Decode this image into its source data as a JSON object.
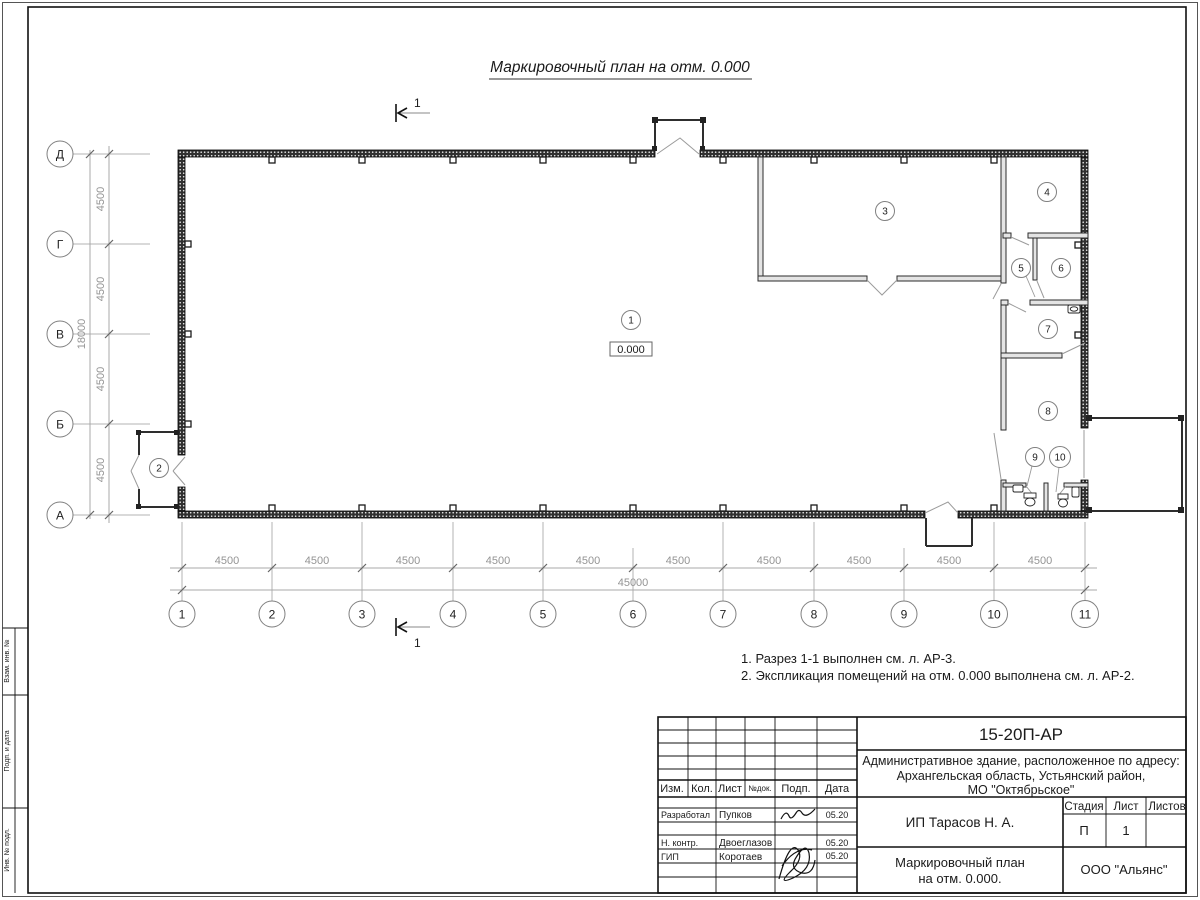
{
  "sheet": {
    "title": "Маркировочный план на отм. 0.000",
    "section_label": "1",
    "notes": [
      "1. Разрез 1-1 выполнен см. л. АР-3.",
      "2. Экспликация помещений на отм. 0.000 выполнена см. л. АР-2."
    ]
  },
  "plan": {
    "elevation": "0.000",
    "rooms": [
      "1",
      "2",
      "3",
      "4",
      "5",
      "6",
      "7",
      "8",
      "9",
      "10"
    ],
    "axes_h": [
      "1",
      "2",
      "3",
      "4",
      "5",
      "6",
      "7",
      "8",
      "9",
      "10",
      "11"
    ],
    "axes_v": [
      "Д",
      "Г",
      "В",
      "Б",
      "А"
    ],
    "dims_bottom": [
      "4500",
      "4500",
      "4500",
      "4500",
      "4500",
      "4500",
      "4500",
      "4500",
      "4500",
      "4500"
    ],
    "dim_bottom_total": "45000",
    "dims_left": [
      "4500",
      "4500",
      "4500",
      "4500"
    ],
    "dim_left_total": "18000"
  },
  "frame_strip": {
    "labels": [
      "Взам. инв. №",
      "Подп. и дата",
      "Инв. № подл."
    ]
  },
  "tb": {
    "doc_number": "15-20П-АР",
    "address_lines": [
      "Административное здание, расположенное по адресу:",
      "Архангельская область, Устьянский район,",
      "МО \"Октябрьское\""
    ],
    "col_izm": "Изм.",
    "col_kol": "Кол.",
    "col_list": "Лист",
    "col_ndoc": "№док.",
    "col_podp": "Подп.",
    "col_data": "Дата",
    "row1_role": "Разработал",
    "row1_name": "Пупков",
    "row1_date": "05.20",
    "row2_role": "Н. контр.",
    "row2_name": "Двоеглазов",
    "row2_date": "05.20",
    "row3_role": "ГИП",
    "row3_name": "Коротаев",
    "row3_date": "05.20",
    "client": "ИП Тарасов Н. А.",
    "stage_label": "Стадия",
    "sheet_label": "Лист",
    "sheets_label": "Листов",
    "stage": "П",
    "sheet_num": "1",
    "name_line1": "Маркировочный план",
    "name_line2": "на отм. 0.000.",
    "company": "ООО \"Альянс\""
  }
}
